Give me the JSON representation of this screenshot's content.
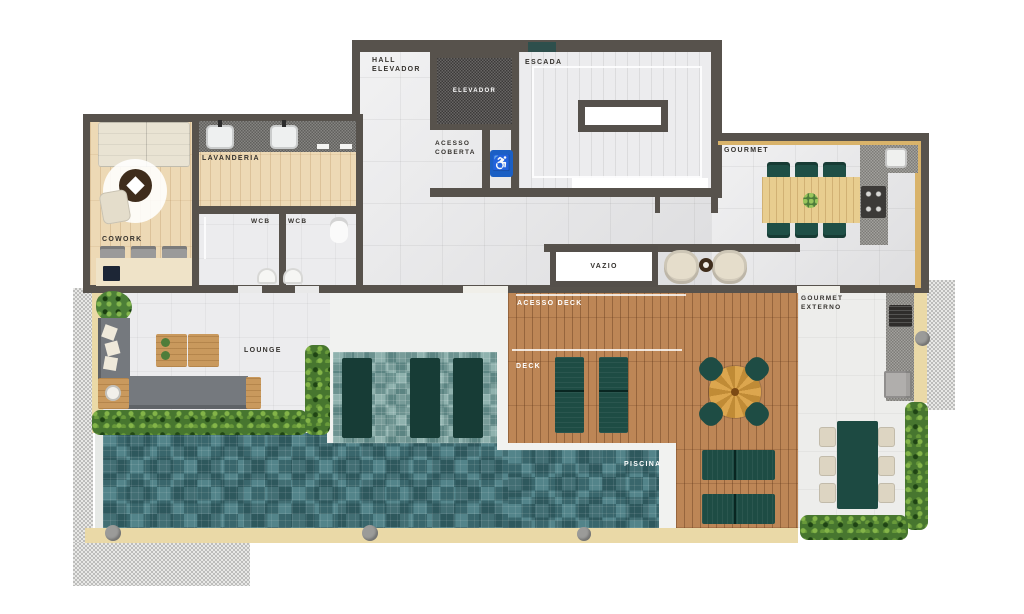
{
  "plan": {
    "rooms": {
      "hall_elevador": {
        "label": "HALL\nELEVADOR"
      },
      "elevador": {
        "label": "ELEVADOR"
      },
      "escada": {
        "label": "ESCADA"
      },
      "acesso_coberta": {
        "label": "ACESSO\nCOBERTA"
      },
      "lavanderia": {
        "label": "LAVANDERIA"
      },
      "cowork": {
        "label": "COWORK"
      },
      "wcb_left": {
        "label": "WCB"
      },
      "wcb_right": {
        "label": "WCB"
      },
      "gourmet": {
        "label": "GOURMET"
      },
      "vazio": {
        "label": "VAZIO"
      },
      "acesso_deck": {
        "label": "ACESSO DECK"
      },
      "deck": {
        "label": "DECK"
      },
      "piscina": {
        "label": "PISCINA"
      },
      "gourmet_externo": {
        "label": "GOURMET\nEXTERNO"
      },
      "lounge": {
        "label": "LOUNGE"
      }
    },
    "icons": {
      "wheelchair_accessible": "♿"
    },
    "colors": {
      "wall": "#57524c",
      "tile_floor": "#e4e4e6",
      "wood_interior": "#edd9b5",
      "wood_deck": "#bd8656",
      "pool_water": "#53848a",
      "pool_shelf": "#8fb2ae",
      "hedge_green": "#47762f",
      "furniture_teal": "#1e4c44",
      "counter_granite": "#8f8d89",
      "sand_trim": "#ead9a7",
      "accessible_blue": "#1b5fc4"
    }
  }
}
